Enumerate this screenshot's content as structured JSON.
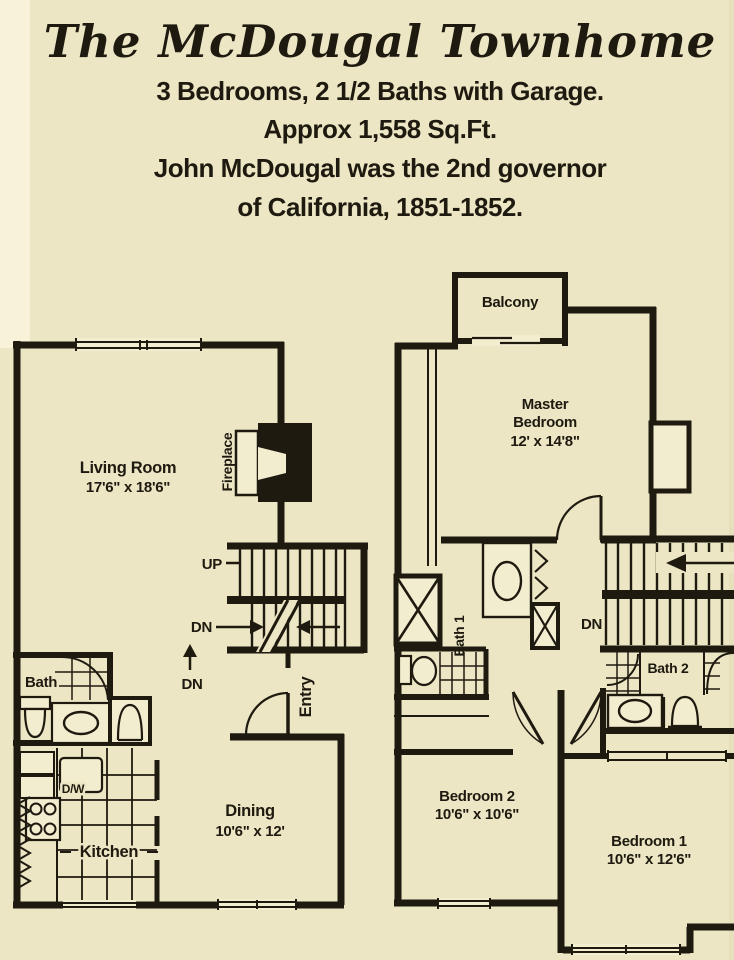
{
  "colors": {
    "page_bg": "#ece6c4",
    "margin_strip": "#f7f2d8",
    "paper_white": "#f3edd0",
    "ink": "#1e1a10"
  },
  "header": {
    "title": "The McDougal Townhome",
    "line1": "3 Bedrooms, 2 1/2 Baths with Garage.",
    "line2": "Approx 1,558 Sq.Ft.",
    "line3": "John McDougal was the 2nd governor",
    "line4": "of California, 1851-1852."
  },
  "floor1": {
    "living_room_name": "Living Room",
    "living_room_dims": "17'6\" x 18'6\"",
    "fireplace_label": "Fireplace",
    "up_label": "UP",
    "dn_stairs_label": "DN",
    "dn_hall_label": "DN",
    "bath_label": "Bath",
    "entry_label": "Entry",
    "dining_name": "Dining",
    "dining_dims": "10'6\" x 12'",
    "kitchen_label": "Kitchen",
    "dishwasher_label": "D/W"
  },
  "floor2": {
    "balcony_label": "Balcony",
    "master_line1": "Master",
    "master_line2": "Bedroom",
    "master_dims": "12' x 14'8\"",
    "bath1_label": "Bath 1",
    "dn_label": "DN",
    "bath2_label": "Bath 2",
    "bedroom2_name": "Bedroom 2",
    "bedroom2_dims": "10'6\" x 10'6\"",
    "bedroom1_name": "Bedroom 1",
    "bedroom1_dims": "10'6\" x 12'6\""
  }
}
